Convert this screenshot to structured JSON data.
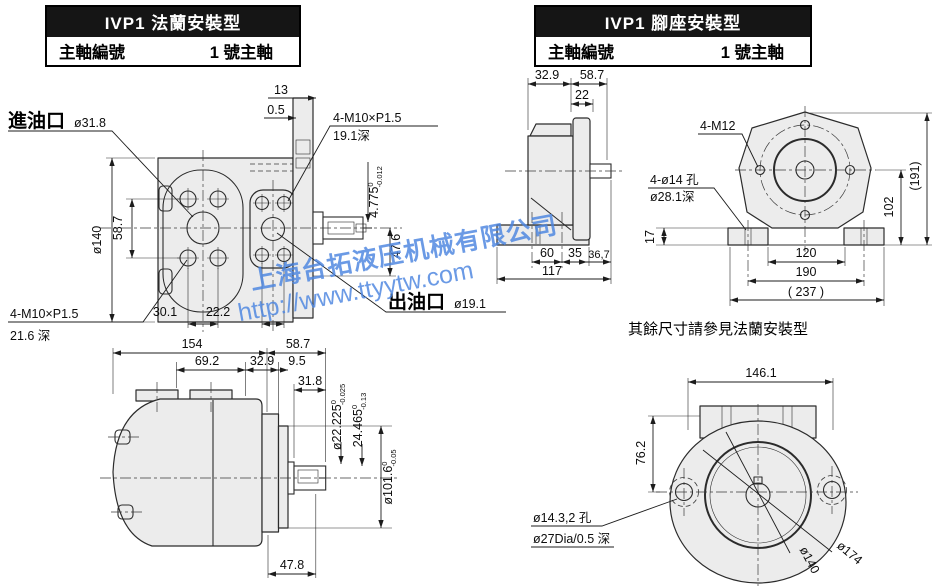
{
  "headers": {
    "flange": {
      "title": "IVP1 法蘭安裝型",
      "row_label": "主軸編號",
      "row_value": "1 號主軸"
    },
    "foot": {
      "title": "IVP1 腳座安裝型",
      "row_label": "主軸編號",
      "row_value": "1 號主軸"
    }
  },
  "watermark": {
    "line1": "上海台拓液压机械有限公司",
    "line2": "http://www.ttyytw.com",
    "color": "#4b85e0"
  },
  "note": "其餘尺寸請參見法蘭安裝型",
  "flange_front": {
    "inlet_label": "進油口",
    "inlet_dia": "ø31.8",
    "outlet_label": "出油口",
    "outlet_dia": "ø19.1",
    "thread_top_1": "4-M10×P1.5",
    "thread_top_2": "19.1深",
    "thread_left_1": "4-M10×P1.5",
    "thread_left_2": "21.6 深",
    "d13": "13",
    "d05": "0.5",
    "dia140": "ø140",
    "d587": "58.7",
    "d4775": "4.775",
    "d4775_hi": "0",
    "d4775_lo": "-0.012",
    "d476": "47.6",
    "d301": "30.1",
    "d222": "22.2"
  },
  "flange_side": {
    "d154": "154",
    "d692": "69.2",
    "d329": "32.9",
    "d95": "9.5",
    "d587": "58.7",
    "d318": "31.8",
    "shaft_dia": "ø22.225",
    "shaft_hi": "0",
    "shaft_lo": "-0.025",
    "key": "24.465",
    "key_hi": "0",
    "key_lo": "-0.13",
    "spigot": "ø101.6",
    "spigot_hi": "0",
    "spigot_lo": "-0.05",
    "d478": "47.8"
  },
  "foot_side": {
    "d329": "32.9",
    "d587": "58.7",
    "d22": "22",
    "d60": "60",
    "d35": "35",
    "d367": "36,7",
    "d117": "117"
  },
  "foot_front": {
    "thread": "4-M12",
    "holes_1": "4-ø14 孔",
    "holes_2": "ø28.1深",
    "d17": "17",
    "d191": "(191)",
    "d102": "102",
    "d120": "120",
    "d190": "190",
    "d237": "( 237 )"
  },
  "rear_view": {
    "d1461": "146.1",
    "d762": "76.2",
    "holes_1": "ø14.3,2 孔",
    "holes_2": "ø27Dia/0.5 深",
    "dia140": "ø140",
    "dia174": "ø174"
  }
}
